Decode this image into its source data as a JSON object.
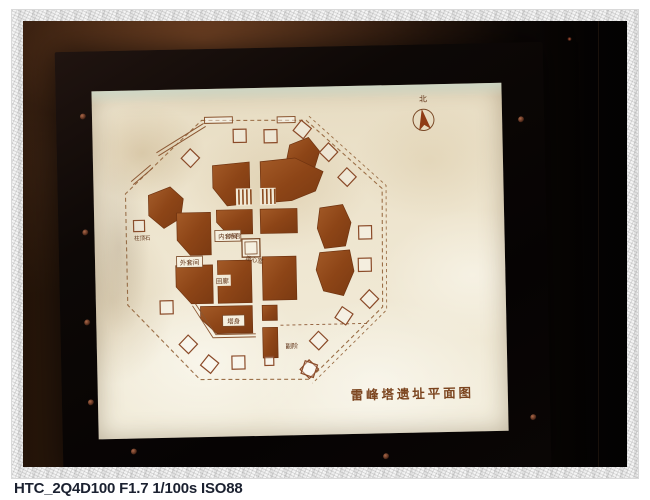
{
  "photo": {
    "caption": "HTC_2Q4D100 F1.7 1/100s ISO88",
    "subject": "backlit museum panel with excavation site plan in black frame"
  },
  "plan": {
    "title": "雷峰塔遗址平面图",
    "north": "北",
    "labels": {
      "inner_suite": "内套间",
      "outer_suite": "外套间",
      "underground_palace": "地宫",
      "pagoda_heart": "塔心室",
      "corridor": "回廊",
      "pagoda_body": "塔身",
      "portico": "副阶",
      "plinth": "柱顶石"
    },
    "colors": {
      "ruin_fill_brown": "#91491b",
      "line_brown": "#9b6f47",
      "panel_cream": "#eee5cf",
      "frame_black": "#0b0705",
      "caption_navy": "#1b2130"
    }
  }
}
